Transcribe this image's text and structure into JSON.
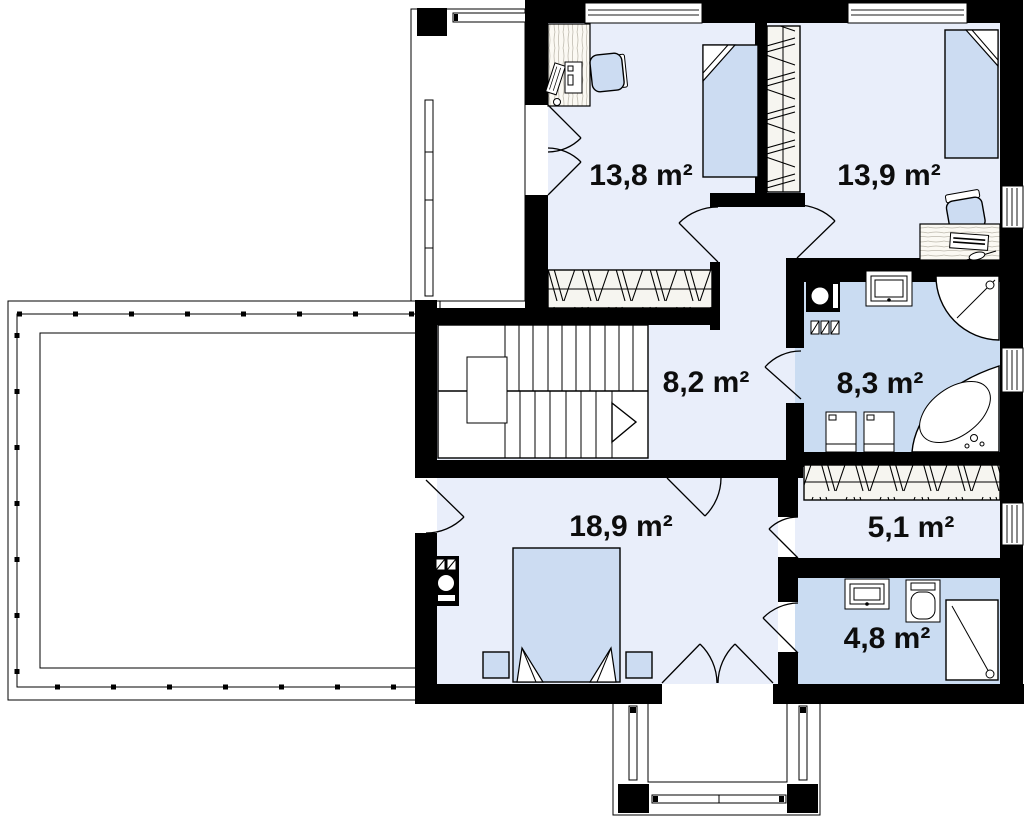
{
  "plan": {
    "title": "First floor plan",
    "rooms": [
      {
        "id": "bedroom-1",
        "area_label": "13,8 m²"
      },
      {
        "id": "bedroom-2",
        "area_label": "13,9 m²"
      },
      {
        "id": "hall-stairs",
        "area_label": "8,2 m²"
      },
      {
        "id": "bathroom-1",
        "area_label": "8,3 m²"
      },
      {
        "id": "bedroom-3",
        "area_label": "18,9 m²"
      },
      {
        "id": "corridor",
        "area_label": "5,1 m²"
      },
      {
        "id": "bathroom-2",
        "area_label": "4,8 m²"
      }
    ],
    "colors": {
      "wall": "#000000",
      "room_floor": "#e9eefa",
      "bath_floor": "#cadcf2",
      "furniture": "#ccdcf2"
    }
  }
}
